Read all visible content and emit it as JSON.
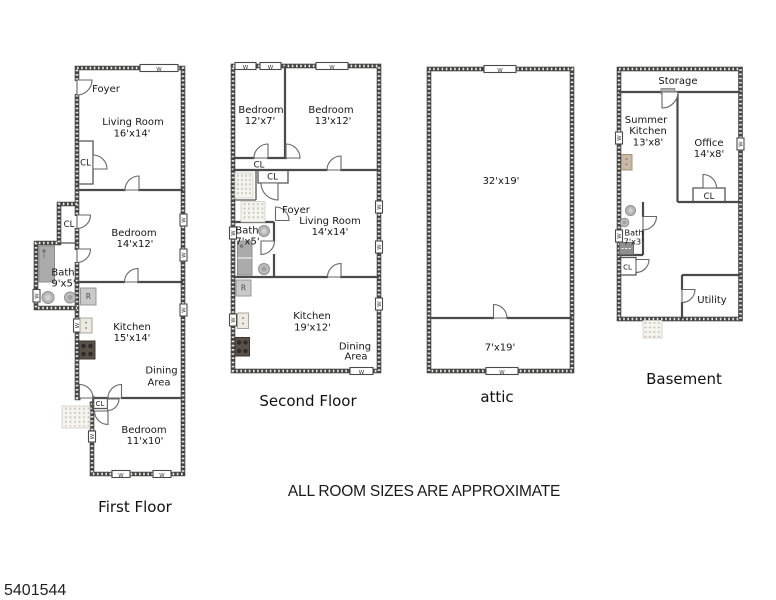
{
  "markers": {
    "window": "W",
    "refrigerator": "R",
    "closet": "CL"
  },
  "first_floor": {
    "title": "First Floor",
    "foyer": "Foyer",
    "living_room": {
      "name": "Living Room",
      "size": "16'x14'"
    },
    "bedroom1": {
      "name": "Bedroom",
      "size": "14'x12'"
    },
    "bath": {
      "name": "Bath",
      "size": "9'x5'"
    },
    "kitchen": {
      "name": "Kitchen",
      "size": "15'x14'"
    },
    "dining": {
      "line1": "Dining",
      "line2": "Area"
    },
    "bedroom2": {
      "name": "Bedroom",
      "size": "11'x10'"
    }
  },
  "second_floor": {
    "title": "Second Floor",
    "bedroom1": {
      "name": "Bedroom",
      "size": "12'x7'"
    },
    "bedroom2": {
      "name": "Bedroom",
      "size": "13'x12'"
    },
    "foyer": "Foyer",
    "living_room": {
      "name": "Living Room",
      "size": "14'x14'"
    },
    "bath": {
      "name": "Bath",
      "size": "7'x5'"
    },
    "kitchen": {
      "name": "Kitchen",
      "size": "19'x12'"
    },
    "dining": {
      "line1": "Dining",
      "line2": "Area"
    }
  },
  "attic": {
    "title": "attic",
    "main_size": "32'x19'",
    "lower_size": "7'x19'"
  },
  "basement": {
    "title": "Basement",
    "storage": "Storage",
    "summer_kitchen": {
      "line1": "Summer",
      "line2": "Kitchen",
      "size": "13'x8'"
    },
    "office": {
      "name": "Office",
      "size": "14'x8'"
    },
    "bath": {
      "name": "Bath",
      "size": "7'x3'"
    },
    "utility": "Utility"
  },
  "footer": {
    "disclaimer": "ALL ROOM SIZES ARE APPROXIMATE",
    "listing_id": "5401544"
  }
}
